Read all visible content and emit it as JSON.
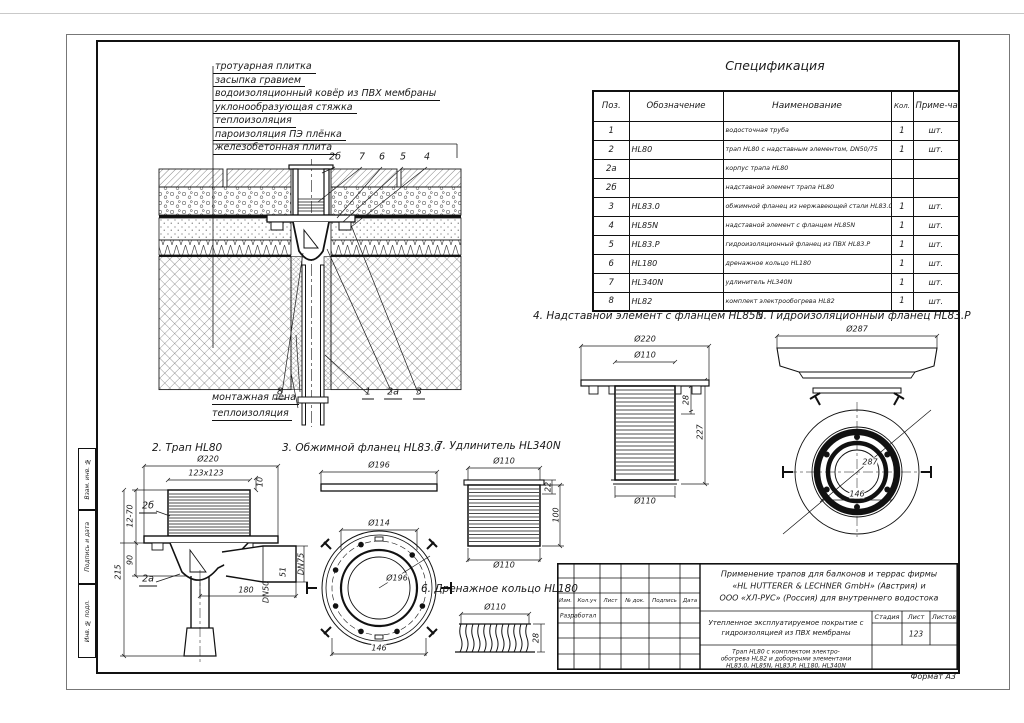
{
  "spec": {
    "title": "Спецификация",
    "columns": [
      "Поз.",
      "Обозначение",
      "Наименование",
      "Кол.",
      "Приме-чание"
    ],
    "rows": [
      [
        "1",
        "",
        "водосточная труба",
        "1",
        "шт."
      ],
      [
        "2",
        "HL80",
        "трап HL80 с надставным элементом, DN50/75",
        "1",
        "шт."
      ],
      [
        "2а",
        "",
        "корпус трапа HL80",
        "",
        ""
      ],
      [
        "2б",
        "",
        "надставной элемент трапа HL80",
        "",
        ""
      ],
      [
        "3",
        "HL83.0",
        "обжимной фланец из нержавеющей стали HL83.0",
        "1",
        "шт."
      ],
      [
        "4",
        "HL85N",
        "надставной элемент с фланцем HL85N",
        "1",
        "шт."
      ],
      [
        "5",
        "HL83.P",
        "гидроизоляционный фланец из ПВХ HL83.P",
        "1",
        "шт."
      ],
      [
        "6",
        "HL180",
        "дренажное кольцо HL180",
        "1",
        "шт."
      ],
      [
        "7",
        "HL340N",
        "удлинитель HL340N",
        "1",
        "шт."
      ],
      [
        "8",
        "HL82",
        "комплект электрообогрева HL82",
        "1",
        "шт."
      ]
    ]
  },
  "layers": [
    "тротуарная плитка",
    "засыпка гравием",
    "водоизоляционный ковёр из ПВХ мембраны",
    "уклонообразующая стяжка",
    "теплоизоляция",
    "пароизоляция ПЭ плёнка",
    "железобетонная плита"
  ],
  "section": {
    "top_callouts": [
      "2б",
      "7",
      "6",
      "5",
      "4"
    ],
    "bottom_callouts": [
      "8",
      "1",
      "2а",
      "3"
    ],
    "label_foam": "монтажная пена",
    "label_insulation": "теплоизоляция"
  },
  "details": {
    "d2": {
      "title": "2. Трап HL80",
      "dia220": "Ø220",
      "grate": "123x123",
      "h10": "10",
      "part_top": "2б",
      "part_body": "2а",
      "range": "12-70",
      "h90": "90",
      "h215": "215",
      "len180": "180",
      "dn75": "DN75",
      "h51": "51",
      "dn50": "DN50"
    },
    "d3": {
      "title": "3. Обжимной фланец HL83.0",
      "bar": "Ø196",
      "inner": "Ø114",
      "outer": "Ø196",
      "bolt": "146"
    },
    "d4": {
      "title": "4. Надставной элемент с фланцем HL85N",
      "flange": "Ø220",
      "pipe_top": "Ø110",
      "h28": "28",
      "h227": "227",
      "pipe_bottom": "Ø110"
    },
    "d5": {
      "title": "5. Гидроизоляционный фланец HL83.P",
      "dia": "Ø287",
      "diag": "287",
      "bolt": "146"
    },
    "d6": {
      "title": "6. Дренажное кольцо HL180",
      "dia": "Ø110",
      "h28": "28"
    },
    "d7": {
      "title": "7. Удлинитель HL340N",
      "top": "Ø110",
      "h22": "22",
      "h100": "100",
      "bottom": "Ø110"
    }
  },
  "side_strip": [
    "Взам. инв. №",
    "Подпись и дата",
    "Инв. № подл."
  ],
  "title_block": {
    "rev_headers": [
      "Изм.",
      "Кол.уч",
      "Лист",
      "№ док.",
      "Подпись",
      "Дата"
    ],
    "role_developed": "Разработал",
    "project_title_l1": "Применение трапов для балконов и террас фирмы",
    "project_title_l2": "«HL HUTTERER & LECHNER GmbH» (Австрия) и",
    "project_title_l3": "ООО «ХЛ-РУС» (Россия) для внутреннего водостока",
    "object_title_l1": "Утепленное эксплуатируемое покрытие с",
    "object_title_l2": "гидроизоляцией из ПВХ мембраны",
    "stage_header": "Стадия",
    "sheet_header": "Лист",
    "sheets_header": "Листов",
    "sheet_value": "123",
    "doc_title_l1": "Трап HL80 с комплектом электро-",
    "doc_title_l2": "обогрева HL82 и доборными элементами",
    "doc_title_l3": "HL83.0, HL85N, HL83.P, HL180, HL340N"
  },
  "format_label": "Формат А3"
}
